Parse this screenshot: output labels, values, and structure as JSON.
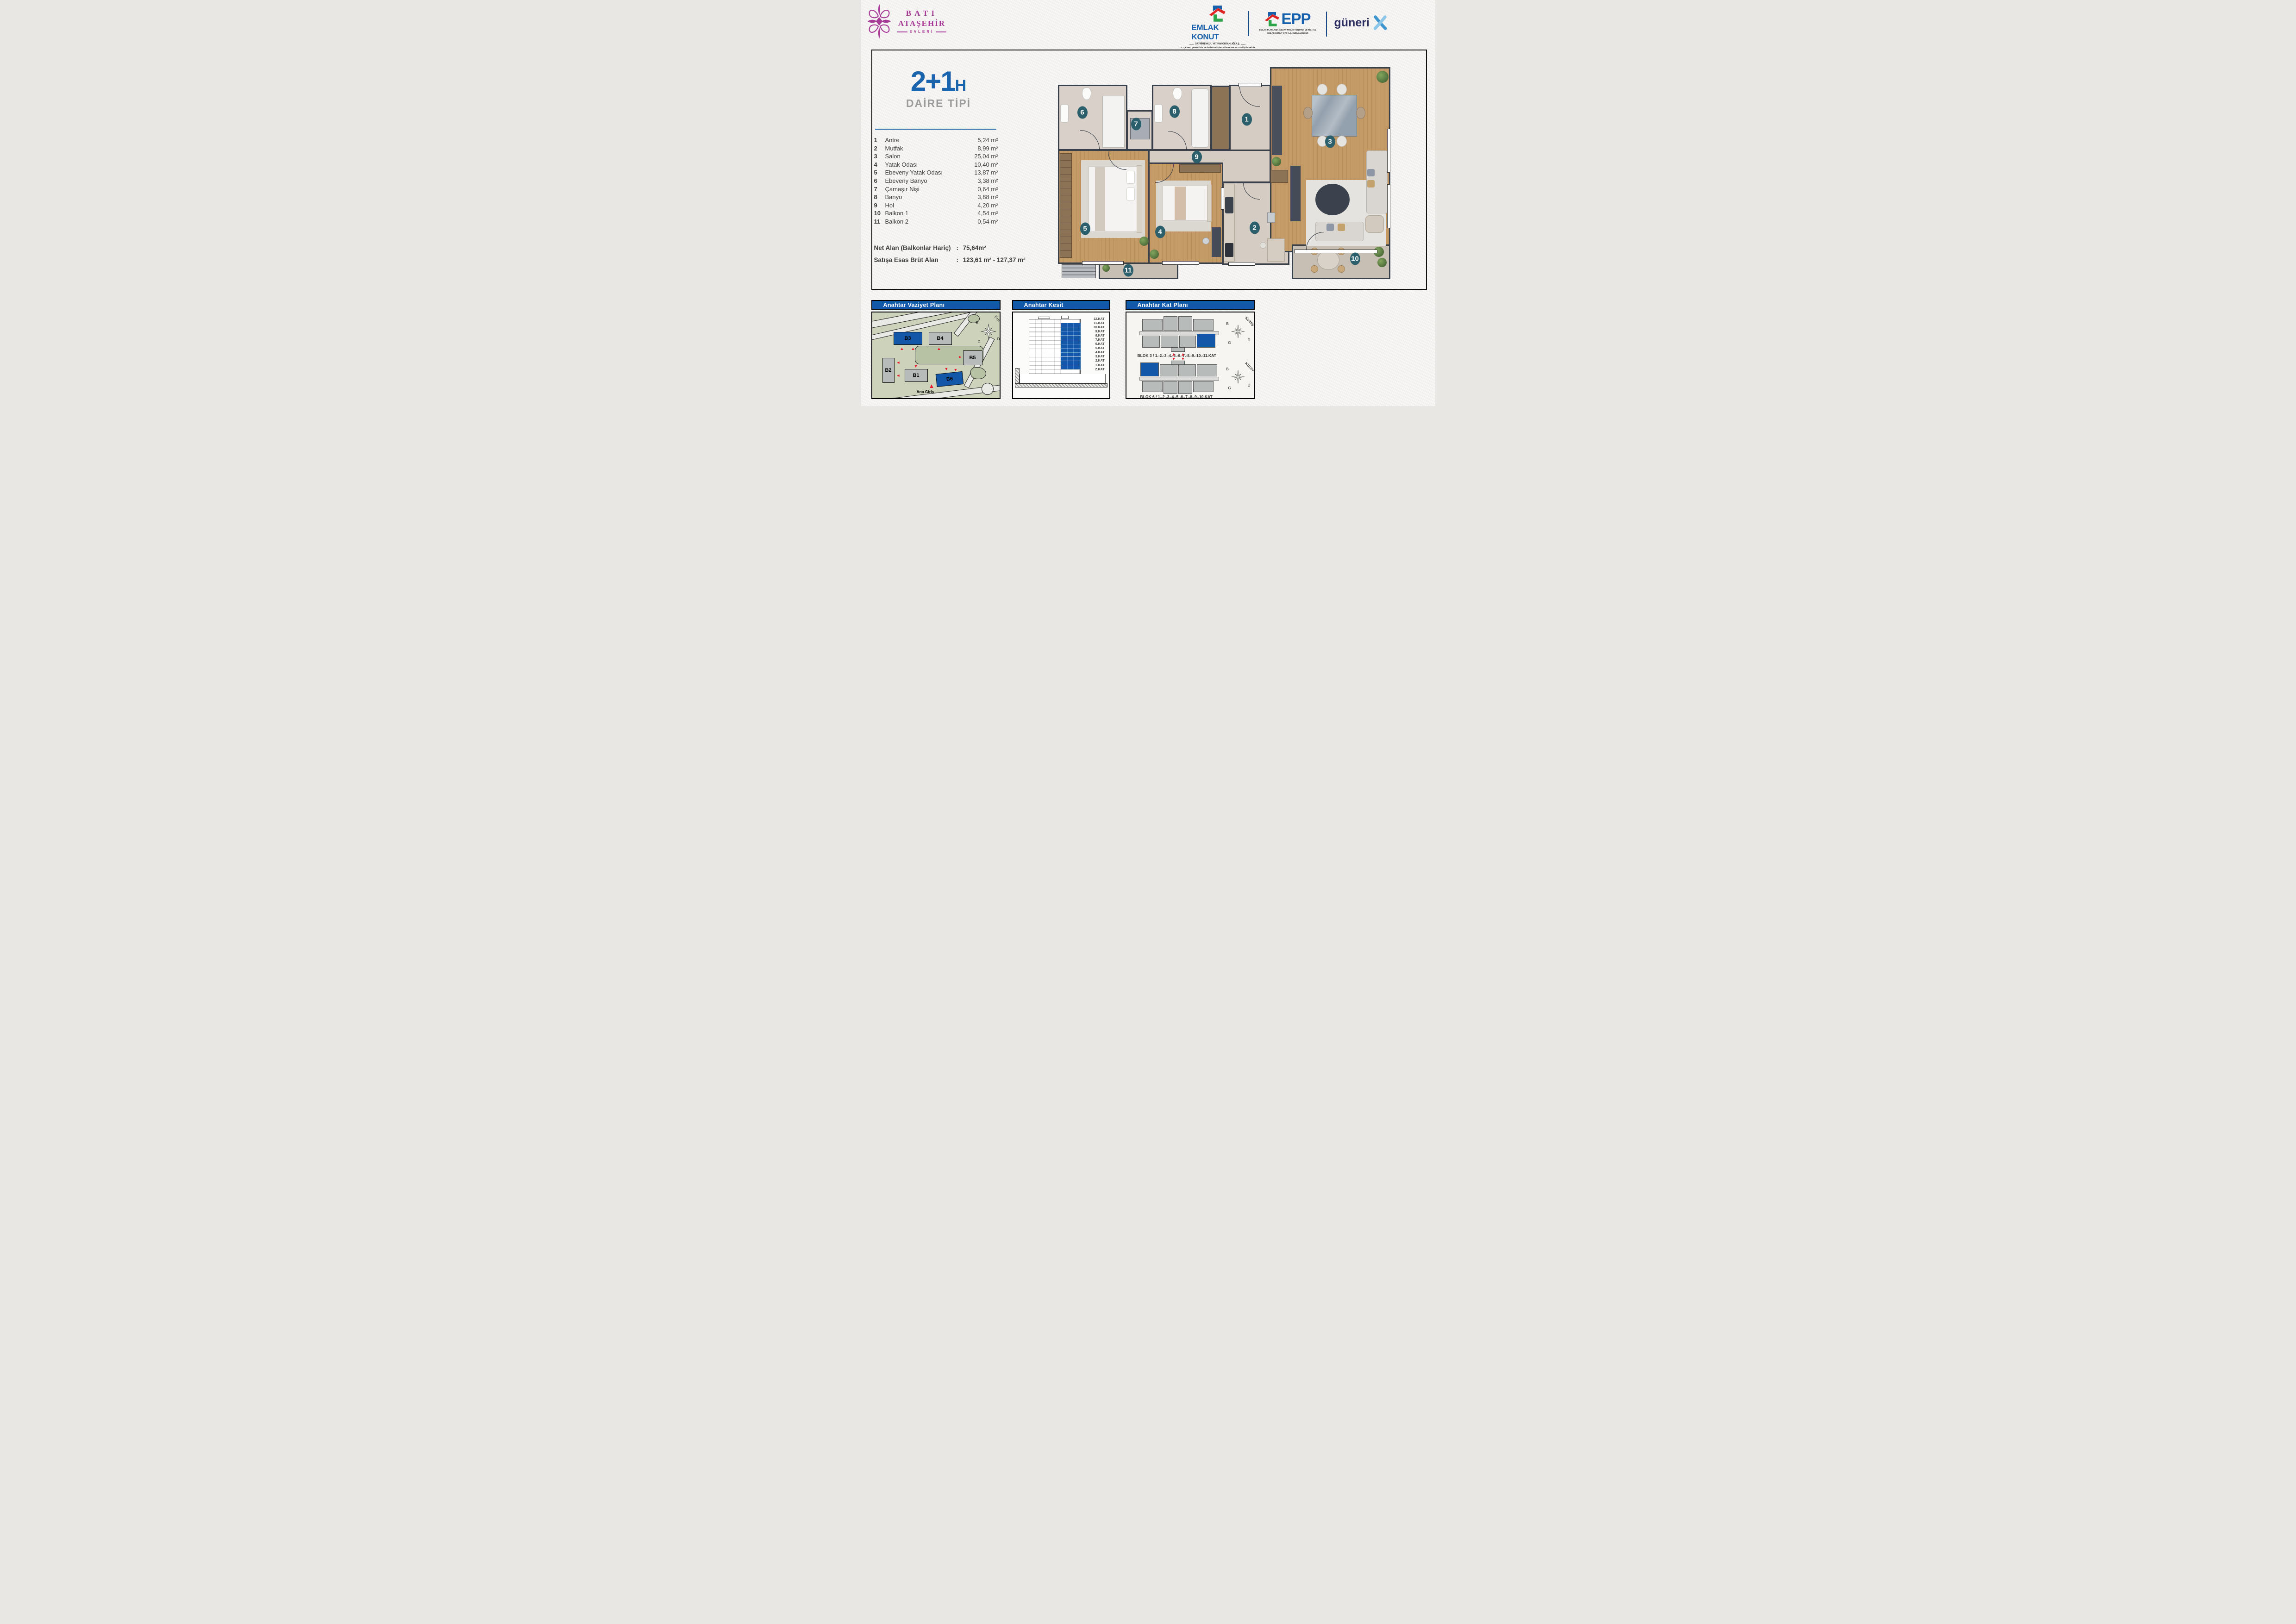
{
  "header": {
    "brand": {
      "line1": "BATI",
      "line2": "ATAŞEHİR",
      "line3": "EVLERİ"
    },
    "emlak_konut": {
      "name": "EMLAK KONUT",
      "sub1": "GAYRİMENKUL YATIRIM ORTAKLIĞI A.Ş.",
      "sub2": "T.C. ÇEVRE, ŞEHİRCİLİK VE İKLİM DEĞİŞİKLİĞİ BAKANLIĞI TOKİ İŞTİRAKİDİR"
    },
    "epp": {
      "name": "EPP",
      "sub1": "EMLAK PLANLAMA İNŞAAT PROJE YÖNETİMİ VE TİC. A.Ş.",
      "sub2": "EMLAK KONUT GYO A.Ş. KURULUŞUDUR"
    },
    "guneri": {
      "name": "güneri"
    }
  },
  "unit": {
    "type": "2+1",
    "type_suffix": "H",
    "subtitle": "DAİRE TİPİ",
    "rooms": [
      {
        "no": "1",
        "name": "Antre",
        "area": "5,24 m²"
      },
      {
        "no": "2",
        "name": "Mutfak",
        "area": "8,99 m²"
      },
      {
        "no": "3",
        "name": "Salon",
        "area": "25,04 m²"
      },
      {
        "no": "4",
        "name": "Yatak Odası",
        "area": "10,40 m²"
      },
      {
        "no": "5",
        "name": "Ebeveny Yatak Odası",
        "area": "13,87 m²"
      },
      {
        "no": "6",
        "name": "Ebeveny Banyo",
        "area": "3,38 m²"
      },
      {
        "no": "7",
        "name": "Çamaşır Nişi",
        "area": "0,64 m²"
      },
      {
        "no": "8",
        "name": "Banyo",
        "area": "3,88 m²"
      },
      {
        "no": "9",
        "name": "Hol",
        "area": "4,20 m²"
      },
      {
        "no": "10",
        "name": "Balkon 1",
        "area": "4,54 m²"
      },
      {
        "no": "11",
        "name": "Balkon 2",
        "area": "0,54 m²"
      }
    ],
    "net_label": "Net Alan (Balkonlar Hariç)",
    "net_value": "75,64m²",
    "gross_label": "Satışa Esas Brüt Alan",
    "gross_value": "123,61 m² - 127,37 m²",
    "colon": ":"
  },
  "panels": {
    "site": {
      "title": "Anahtar Vaziyet Planı",
      "buildings": [
        {
          "id": "B3",
          "highlight": true
        },
        {
          "id": "B4",
          "highlight": false
        },
        {
          "id": "B5",
          "highlight": false
        },
        {
          "id": "B2",
          "highlight": false
        },
        {
          "id": "B1",
          "highlight": false
        },
        {
          "id": "B6",
          "highlight": true
        }
      ],
      "entrance_label": "Ana Giriş"
    },
    "section": {
      "title": "Anahtar Kesit",
      "floors": [
        "12.KAT",
        "11.KAT",
        "10.KAT",
        "9.KAT",
        "8.KAT",
        "7.KAT",
        "6.KAT",
        "5.KAT",
        "4.KAT",
        "3.KAT",
        "2.KAT",
        "1.KAT",
        "Z.KAT"
      ]
    },
    "keyplan": {
      "title": "Anahtar Kat Planı",
      "block_top_caption": "BLOK 3 / 1.-2.-3.-4.-5.-6.-7.-8.-9.-10.-11.KAT",
      "block_bottom_caption": "BLOK 6 / 1.-2.-3.-4.-5.-6.-7.-8.-9.-10.KAT"
    },
    "compass": {
      "north": "Kuzey",
      "w": "B",
      "e": "D",
      "s": "G"
    }
  },
  "colors": {
    "accent_blue": "#1358a8",
    "title_blue": "#1a63ad",
    "badge_teal": "#2b5f6b",
    "brand_purple": "#a63a96",
    "logo_blue": "#1760ab",
    "logo_red": "#e02424",
    "logo_green": "#2da44a",
    "guneri_navy": "#2b2d5e",
    "wall_dark": "#3a4049",
    "highlight_red": "#e8192c"
  }
}
